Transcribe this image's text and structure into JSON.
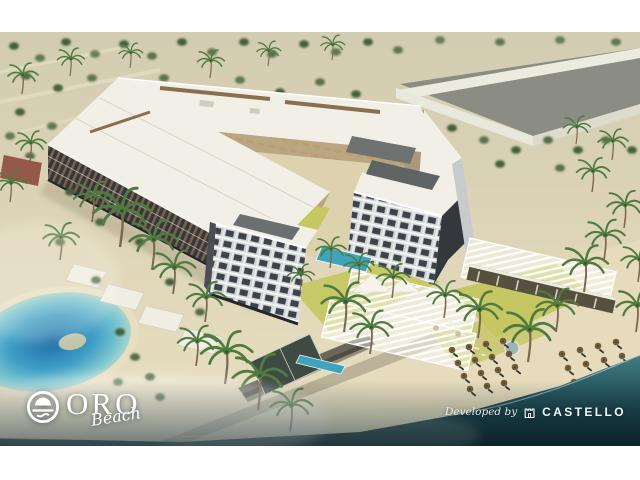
{
  "brand": {
    "name": "ORO",
    "tagline": "Beach",
    "icon": "sun-over-waves-icon"
  },
  "developer": {
    "label": "Developed by",
    "name": "CASTELLO",
    "icon": "castle-icon"
  },
  "colors": {
    "margin_white": "#ffffff",
    "desert": "#d8d1b5",
    "sand": "#e6dcbd",
    "roof": "#f2efe6",
    "facade_dark": "#34373c",
    "louver_bronze": "#8a6e4e",
    "inner_facade_tan": "#b9a783",
    "tower_light": "#d3d6d8",
    "lawn": "#c5c763",
    "pool": "#3ea4bc",
    "lagoon_deep": "#1e6ea8",
    "sea_deep": "#12303a",
    "tree_green": "#44613a",
    "palm_green": "#4f7a40",
    "umbrella_brown": "#6f5d3e",
    "wall_white": "#e9e8dc",
    "text_white": "#ffffff"
  }
}
